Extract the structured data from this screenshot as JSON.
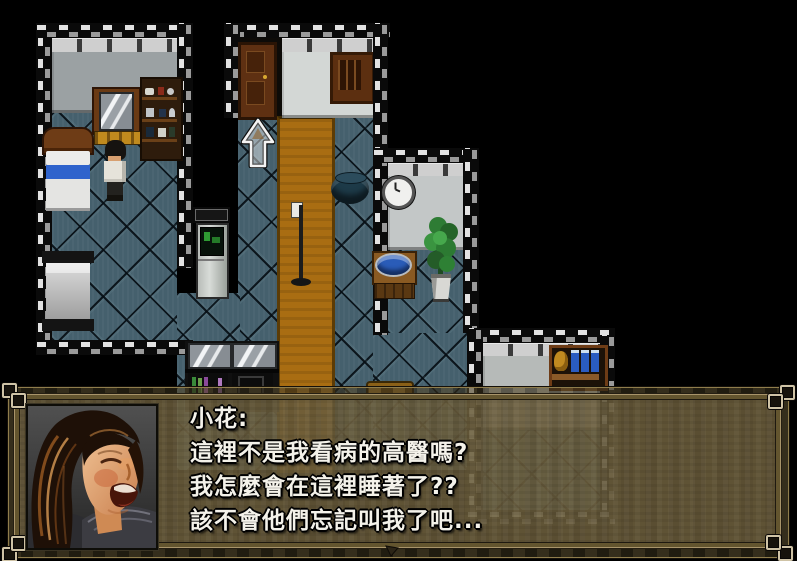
{
  "game": {
    "dialog": {
      "speaker": "小花:",
      "line1": "這裡不是我看病的高醫嗎?",
      "line2": "我怎麼會在這裡睡著了??",
      "line3": "該不會他們忘記叫我了吧...",
      "portrait": "laughing-woman-photo",
      "text_color": "#f4f2ea",
      "box_color": "#5a5036",
      "frame_color": "#8a7848"
    },
    "map": {
      "floor_tile_color": "#45606d",
      "carpet_color": "#a96d12",
      "wall_colors": [
        "#9ba1a3",
        "#d3d7d5",
        "#c3c7c7",
        "#b6bab8"
      ],
      "objects": [
        "bed",
        "bed",
        "dresser-mirror",
        "item-shelf",
        "player-character",
        "wooden-door",
        "wall-cabinet",
        "vending-machine",
        "destination-arrow",
        "cauldron",
        "iv-stand",
        "wall-clock",
        "washbasin",
        "potted-plant",
        "display-counter",
        "medicine-shelf",
        "stool"
      ]
    }
  }
}
